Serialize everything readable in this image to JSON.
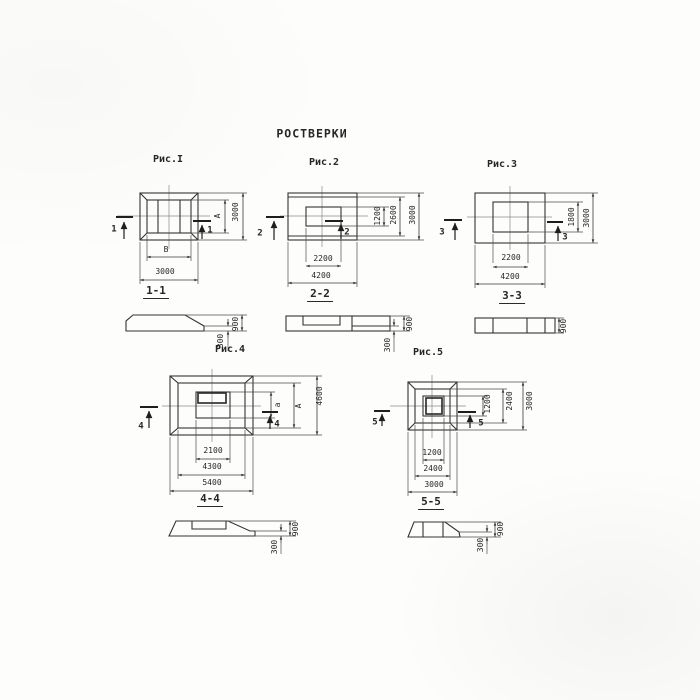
{
  "title": "РОСТВЕРКИ",
  "figures": [
    {
      "name": "Рис.I",
      "cut_number": "1",
      "plan": {
        "width_inner": "В",
        "width_outer": "3000",
        "height_inner": "А",
        "height_outer": "3000"
      },
      "section": {
        "title": "1-1",
        "total_height": "900",
        "edge_height": "300"
      }
    },
    {
      "name": "Рис.2",
      "cut_number": "2",
      "plan": {
        "width_inner": "2200",
        "width_outer": "4200",
        "height_inner": "1200",
        "height_middle": "2600",
        "height_outer": "3000"
      },
      "section": {
        "title": "2-2",
        "total_height": "900",
        "edge_height": "300"
      }
    },
    {
      "name": "Рис.3",
      "cut_number": "3",
      "plan": {
        "width_inner": "2200",
        "width_outer": "4200",
        "height_inner": "1800",
        "height_outer": "3000"
      },
      "section": {
        "title": "3-3",
        "total_height": "900"
      }
    },
    {
      "name": "Рис.4",
      "cut_number": "4",
      "plan": {
        "width_inner": "2100",
        "width_middle": "4300",
        "width_outer": "5400",
        "height_inner": "а",
        "height_middle": "А",
        "height_outer": "4600"
      },
      "section": {
        "title": "4-4",
        "total_height": "900",
        "edge_height": "300"
      }
    },
    {
      "name": "Рис.5",
      "cut_number": "5",
      "plan": {
        "width_inner": "1200",
        "width_middle": "2400",
        "width_outer": "3000",
        "height_inner": "1200",
        "height_middle": "2400",
        "height_outer": "3000"
      },
      "section": {
        "title": "5-5",
        "total_height": "900",
        "edge_height": "300"
      }
    }
  ],
  "colors": {
    "ink": "#333333",
    "paper": "#fdfdfb"
  }
}
